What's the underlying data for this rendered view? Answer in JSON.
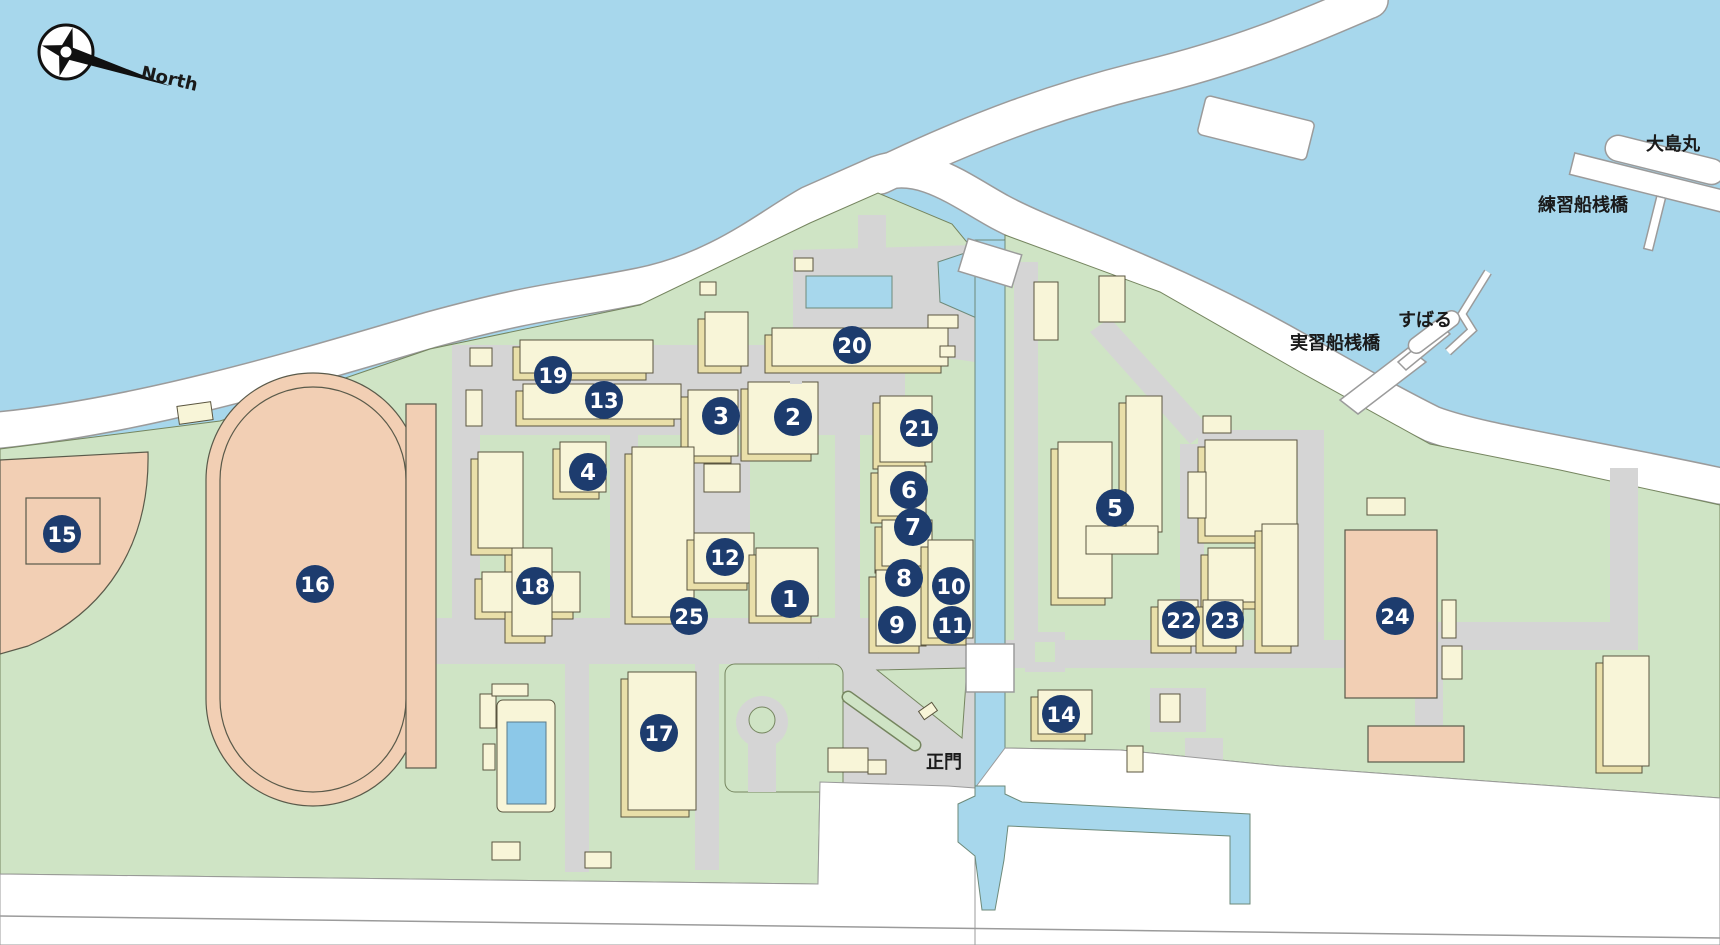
{
  "title": "campus-map",
  "labels": {
    "north": "North",
    "oshimamaru": "大島丸",
    "renshusen_sanbashi": "練習船桟橋",
    "subaru": "すばる",
    "jisshusen_sanbashi": "実習船桟橋",
    "seimon": "正門"
  },
  "colors": {
    "water": "#a7d7ec",
    "land": "#cfe4c5",
    "road": "#d5d5d5",
    "building": "#f8f5d8",
    "building_side": "#e9dfa9",
    "field": "#f2cfb4",
    "pool": "#8cc8e8",
    "marker": "#1d3c6e",
    "marker_text": "#ffffff",
    "label_text": "#1a1a1a"
  },
  "markers": [
    {
      "n": 1,
      "x": 790,
      "y": 599
    },
    {
      "n": 2,
      "x": 793,
      "y": 417
    },
    {
      "n": 3,
      "x": 721,
      "y": 416
    },
    {
      "n": 4,
      "x": 588,
      "y": 472
    },
    {
      "n": 5,
      "x": 1115,
      "y": 508
    },
    {
      "n": 6,
      "x": 909,
      "y": 490
    },
    {
      "n": 7,
      "x": 913,
      "y": 527
    },
    {
      "n": 8,
      "x": 904,
      "y": 578
    },
    {
      "n": 9,
      "x": 897,
      "y": 625
    },
    {
      "n": 10,
      "x": 951,
      "y": 586
    },
    {
      "n": 11,
      "x": 952,
      "y": 625
    },
    {
      "n": 12,
      "x": 725,
      "y": 557
    },
    {
      "n": 13,
      "x": 604,
      "y": 400
    },
    {
      "n": 14,
      "x": 1061,
      "y": 714
    },
    {
      "n": 15,
      "x": 62,
      "y": 534
    },
    {
      "n": 16,
      "x": 315,
      "y": 584
    },
    {
      "n": 17,
      "x": 659,
      "y": 733
    },
    {
      "n": 18,
      "x": 535,
      "y": 586
    },
    {
      "n": 19,
      "x": 553,
      "y": 375
    },
    {
      "n": 20,
      "x": 852,
      "y": 345
    },
    {
      "n": 21,
      "x": 919,
      "y": 428
    },
    {
      "n": 22,
      "x": 1181,
      "y": 620
    },
    {
      "n": 23,
      "x": 1225,
      "y": 620
    },
    {
      "n": 24,
      "x": 1395,
      "y": 616
    },
    {
      "n": 25,
      "x": 689,
      "y": 616
    }
  ]
}
